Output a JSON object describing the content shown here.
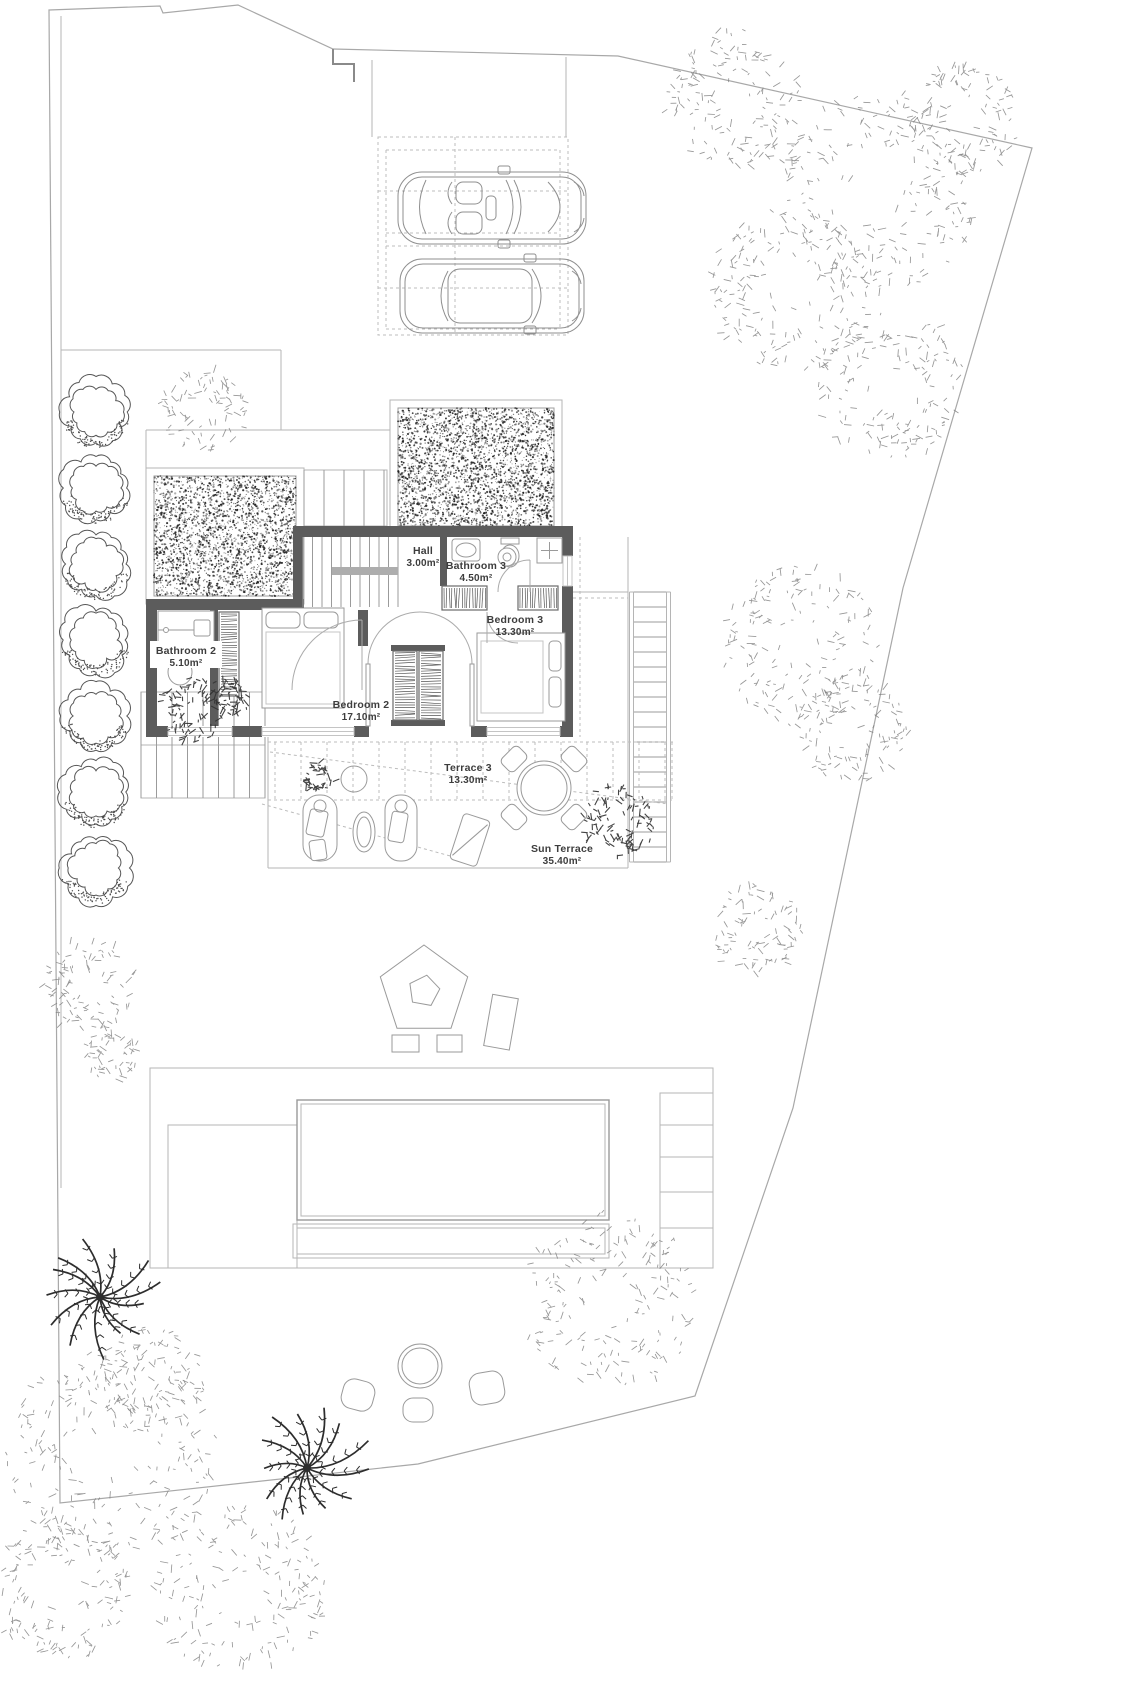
{
  "plan_type": "first floor site plan",
  "rooms": {
    "hall": {
      "name": "Hall",
      "area": "3.00m²"
    },
    "bathroom3": {
      "name": "Bathroom 3",
      "area": "4.50m²"
    },
    "bedroom3": {
      "name": "Bedroom 3",
      "area": "13.30m²"
    },
    "bathroom2": {
      "name": "Bathroom 2",
      "area": "5.10m²"
    },
    "bedroom2": {
      "name": "Bedroom 2",
      "area": "17.10m²"
    },
    "terrace3": {
      "name": "Terrace 3",
      "area": "13.30m²"
    },
    "sun_terrace": {
      "name": "Sun Terrace",
      "area": "35.40m²"
    }
  },
  "style": {
    "wall_color": "#5c5c5c",
    "line_color": "#b5b5b5",
    "boundary_color": "#a8a8a8",
    "text_color": "#3d3d3d",
    "paper_color": "#ffffff"
  },
  "plan": {
    "stipple_rects": [
      {
        "x": 154,
        "y": 476,
        "w": 142,
        "h": 120
      },
      {
        "x": 398,
        "y": 408,
        "w": 156,
        "h": 118
      }
    ],
    "trees_light": [
      {
        "x": 735,
        "y": 100,
        "r": 70
      },
      {
        "x": 880,
        "y": 190,
        "r": 100
      },
      {
        "x": 965,
        "y": 120,
        "r": 55
      },
      {
        "x": 790,
        "y": 290,
        "r": 80
      },
      {
        "x": 890,
        "y": 385,
        "r": 75
      },
      {
        "x": 203,
        "y": 411,
        "r": 42
      },
      {
        "x": 800,
        "y": 645,
        "r": 80
      },
      {
        "x": 852,
        "y": 728,
        "r": 55
      },
      {
        "x": 757,
        "y": 930,
        "r": 45
      },
      {
        "x": 88,
        "y": 985,
        "r": 46
      },
      {
        "x": 112,
        "y": 1055,
        "r": 26
      },
      {
        "x": 610,
        "y": 1300,
        "r": 88
      },
      {
        "x": 112,
        "y": 1455,
        "r": 105
      },
      {
        "x": 62,
        "y": 1590,
        "r": 72
      },
      {
        "x": 240,
        "y": 1590,
        "r": 85
      },
      {
        "x": 152,
        "y": 1380,
        "r": 55
      }
    ],
    "bushes_dark": [
      {
        "x": 195,
        "y": 710,
        "r": 33
      },
      {
        "x": 232,
        "y": 698,
        "r": 17
      },
      {
        "x": 620,
        "y": 820,
        "r": 36
      },
      {
        "x": 318,
        "y": 777,
        "r": 16
      }
    ],
    "palms": [
      {
        "x": 100,
        "y": 1297,
        "r": 60
      },
      {
        "x": 307,
        "y": 1468,
        "r": 66
      }
    ],
    "hedge_row": {
      "x": 96,
      "y_start": 412,
      "step": 76,
      "count": 7,
      "r": 35
    }
  }
}
